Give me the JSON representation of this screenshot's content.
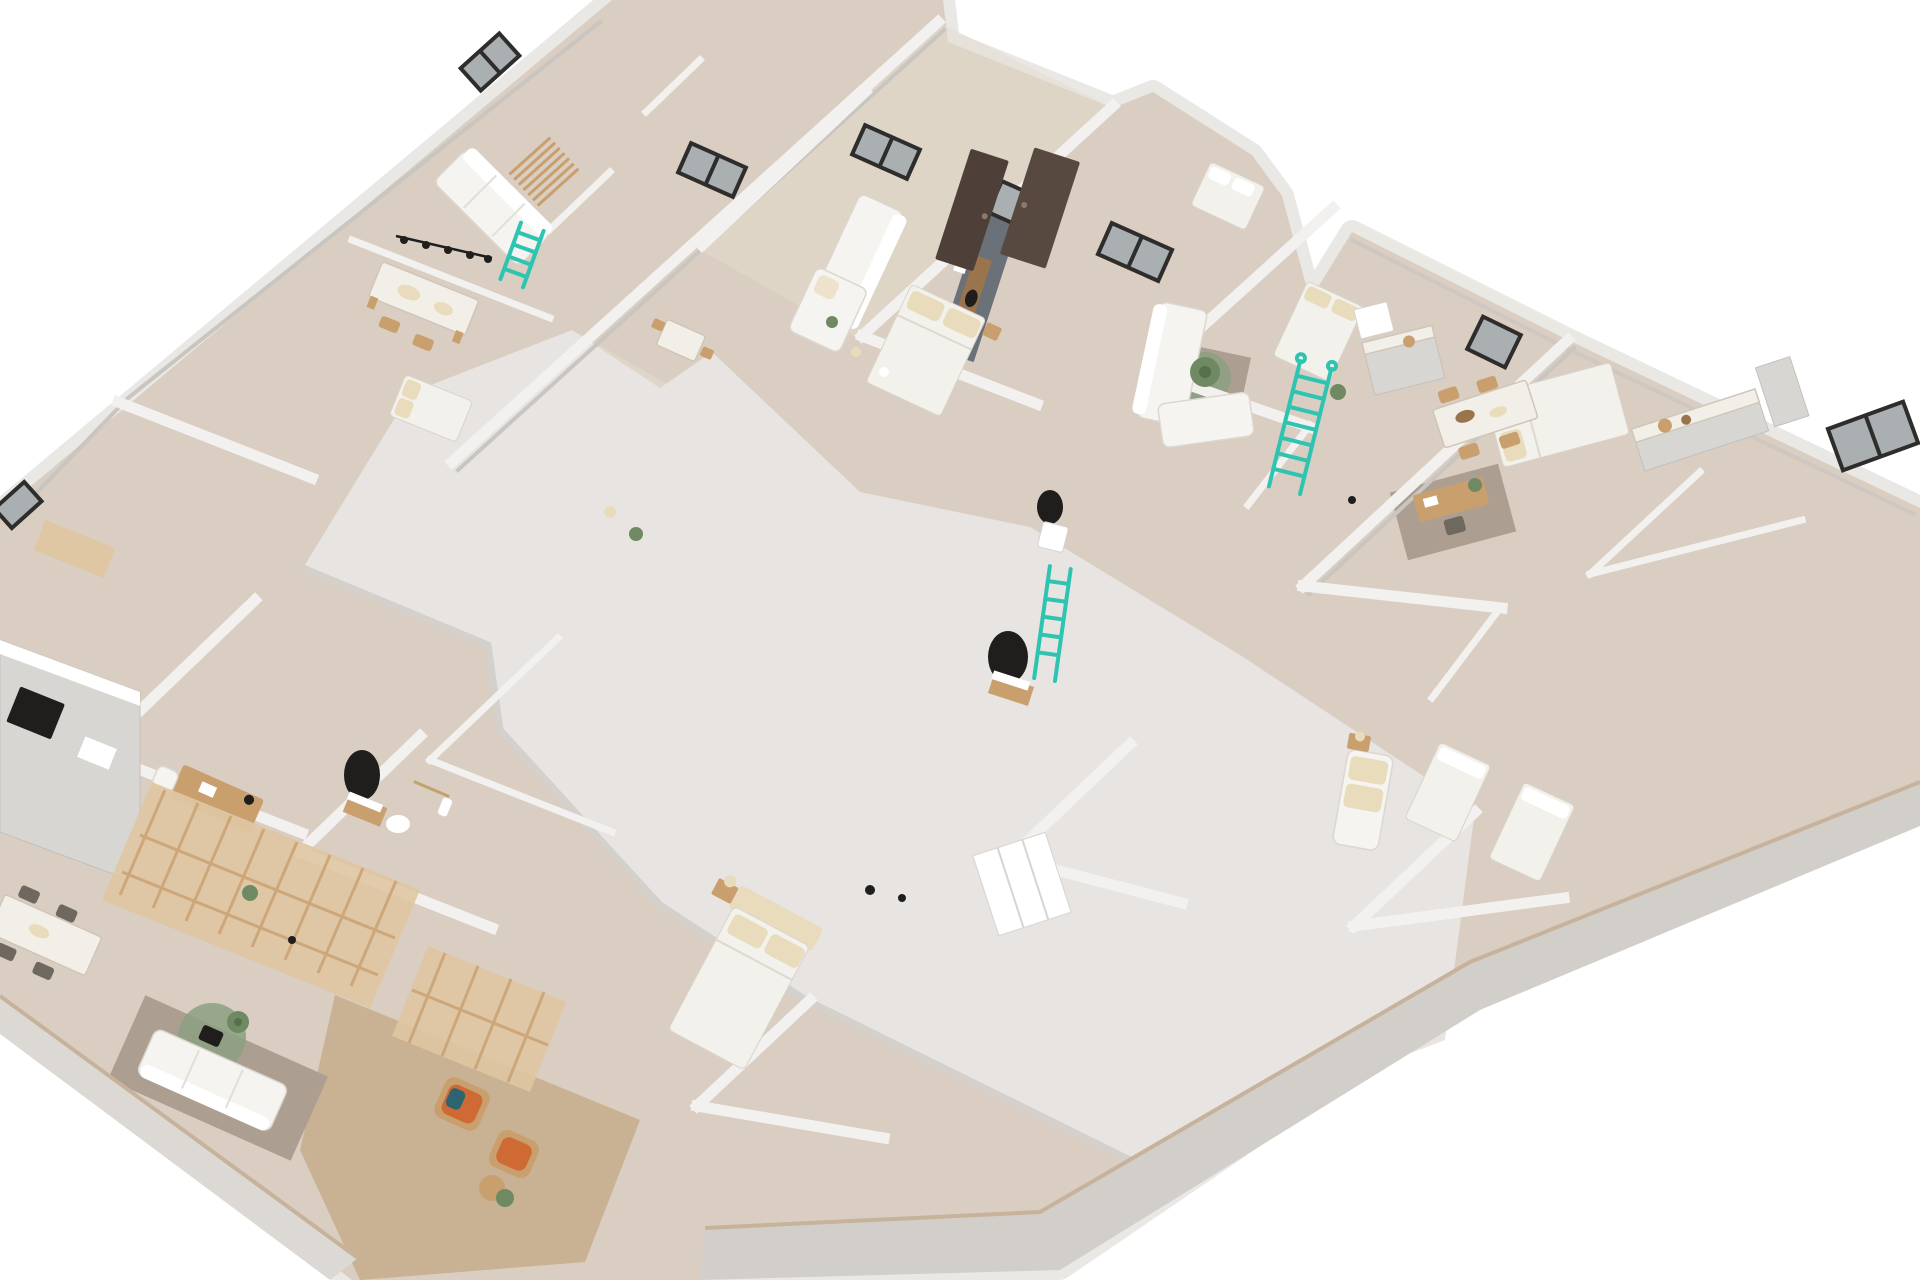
{
  "meta": {
    "title": "3D cutaway floor plan render",
    "description": "Axonometric cutaway rendering of a full residential floor with multiple apartments, white walls, beige floors and teal accent ladders on a plain white background.",
    "visible_text": "none"
  },
  "palette": {
    "background": "#ffffff",
    "wall_top": "#f3f1ef",
    "wall_light": "#eae8e5",
    "wall_shadow": "#c9c5c0",
    "wall_band": "#dcd9d5",
    "wall_band_dark": "#d2cfca",
    "slab": "#e7e4e1",
    "slab_shadow": "#d4d1cd",
    "floor_beige": "#d9cec1",
    "floor_beige_light": "#e4dbce",
    "floor_wood": "#c9b193",
    "floor_wood_light": "#dfc7a3",
    "rug_brown": "#ac9f91",
    "rug_olive": "#8ca083",
    "accent_teal": "#2ec4b2",
    "wood_mid": "#c99f6e",
    "wood_dark": "#9a744d",
    "sofa_white": "#f6f4f0",
    "cushion_cream": "#e9dcbc",
    "duvet_white": "#f3f1ec",
    "marble": "#f2efe9",
    "ink": "#1f1e1c",
    "window_frame": "#2e2d2b",
    "window_glass": "#aab0b2",
    "door_brown": "#4e4038",
    "cushion_orange": "#cf6a34",
    "plant_green": "#6f8a62",
    "tan_edge": "#c7b29b"
  },
  "scene": {
    "projection": "rotated top-down axonometric with cutaway walls",
    "building": {
      "outline": "irregular pentagon, cropped by image edges at top and left",
      "core": "large blank light-grey slab covering the central circulation core"
    },
    "apartments": [
      {
        "name": "top-left-apartment",
        "items": [
          "dining-table",
          "pendant-lamp",
          "white-sofa",
          "wood-slat-partition",
          "teal-ladder",
          "bed",
          "window"
        ]
      },
      {
        "name": "center-apartment",
        "items": [
          "l-shaped-sofa",
          "tv-media-wall",
          "double-bed",
          "dining-table",
          "dark-entry-doors",
          "windows"
        ]
      },
      {
        "name": "right-center-apartment",
        "items": [
          "l-shaped-sofa",
          "area-rug",
          "potted-plant",
          "double-bed",
          "kitchen-counter",
          "big-teal-ladder"
        ]
      },
      {
        "name": "right-apartment",
        "items": [
          "kitchen-counter",
          "dining-table-with-chairs",
          "desk-with-chair",
          "double-bed",
          "cream-sofa",
          "large-window"
        ]
      },
      {
        "name": "bottom-left-apartment",
        "items": [
          "kitchen-run",
          "black-cooktop",
          "dining-table",
          "desk",
          "bathroom-black-mirror",
          "rattan-screen",
          "white-sofa",
          "round-olive-rug"
        ]
      },
      {
        "name": "bottom-center-apartment",
        "items": [
          "double-bed-with-headboard",
          "nightstand-lamp",
          "wardrobe",
          "bathroom-black-mirror"
        ]
      },
      {
        "name": "bottom-terrace",
        "items": [
          "wood-deck-floor",
          "wicker-chair-orange-cushion",
          "wicker-chair-orange-cushion",
          "round-side-table",
          "potted-plant"
        ]
      }
    ],
    "accents": {
      "teal_ladders": 3,
      "black_round_mirrors": 3,
      "dark_window_frames": 8,
      "dark_doors": 2
    }
  }
}
